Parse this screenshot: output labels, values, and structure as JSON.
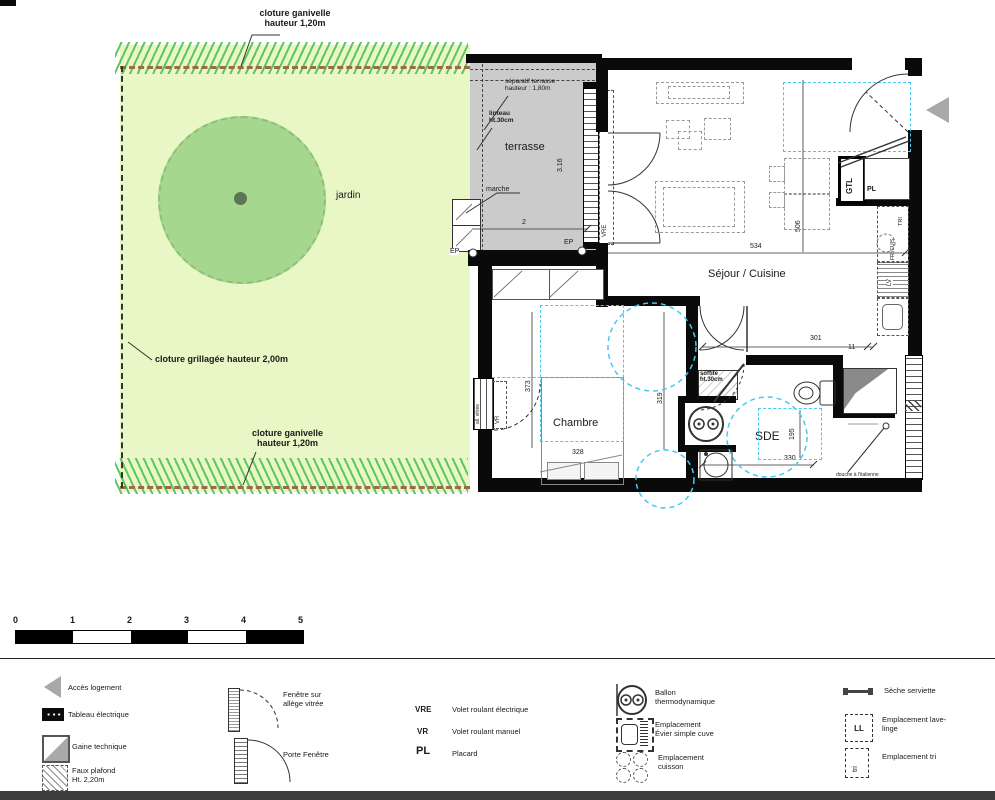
{
  "colors": {
    "garden_fill": "#e9f6c6",
    "garden_hatch": "#5cc75c",
    "tree_fill": "#a5d78e",
    "tree_dot": "#5d7456",
    "fence_dash": "#9a6a4a",
    "terrace_fill": "#cbcbcb",
    "wall": "#0a0a0a",
    "false_ceiling_blue": "#45c8f5",
    "furniture_dash": "#9a9a9a",
    "access_arrow": "#a8a8a8"
  },
  "site": {
    "garden_label": "jardin",
    "fence_top": "cloture ganivelle\nhauteur 1,20m",
    "fence_left": "cloture grillagée hauteur 2,00m",
    "fence_bottom": "cloture ganivelle\nhauteur 1,20m"
  },
  "terrace": {
    "label": "terrasse",
    "separator": "séparatif terrasse\nhauteur : 1,80m",
    "lintel": "linteau\nht.30cm",
    "step": "marche",
    "dim_depth": "3.16",
    "dim_width": "2",
    "ep_left": "EP",
    "ep_right": "EP"
  },
  "living": {
    "label": "Séjour / Cuisine",
    "dim_width": "534",
    "dim_height": "506",
    "dim_hall": "301",
    "dim_small": "11",
    "vre": "VRE",
    "gtl": "GTL",
    "pl": "PL",
    "tri": "TRI",
    "fri_cuis": "FRI/CUIS",
    "lv": "LV"
  },
  "bedroom": {
    "label": "Chambre",
    "dim_width": "328",
    "dim_height": "373",
    "dim_right": "319",
    "window": "all. vitrée",
    "vr": "VR"
  },
  "bathroom": {
    "label": "SDE",
    "dim_width": "330",
    "dim_height": "195",
    "soffit": "soffite\nht.30cm",
    "shower": "douche à l'italienne"
  },
  "scalebar": {
    "ticks": [
      "0",
      "1",
      "2",
      "3",
      "4",
      "5"
    ]
  },
  "legend": {
    "access": "Accès logement",
    "panel": "Tableau électrique",
    "duct": "Gaine technique",
    "ceiling": "Faux plafond\nHt. 2,20m",
    "window_sill": "Fenêtre sur\nallège vitrée",
    "french_door": "Porte Fenêtre",
    "vre_abbr": "VRE",
    "vre_label": "Volet roulant électrique",
    "vr_abbr": "VR",
    "vr_label": "Volet roulant manuel",
    "pl_abbr": "PL",
    "pl_label": "Placard",
    "boiler": "Ballon\nthermodynamique",
    "sink": "Emplacement\nÉvier simple cuve",
    "cooking": "Emplacement\ncuisson",
    "towel": "Sèche serviette",
    "washer_abbr": "LL",
    "washer": "Emplacement lave-\nlinge",
    "tri_abbr": "tri",
    "tri": "Emplacement tri"
  }
}
